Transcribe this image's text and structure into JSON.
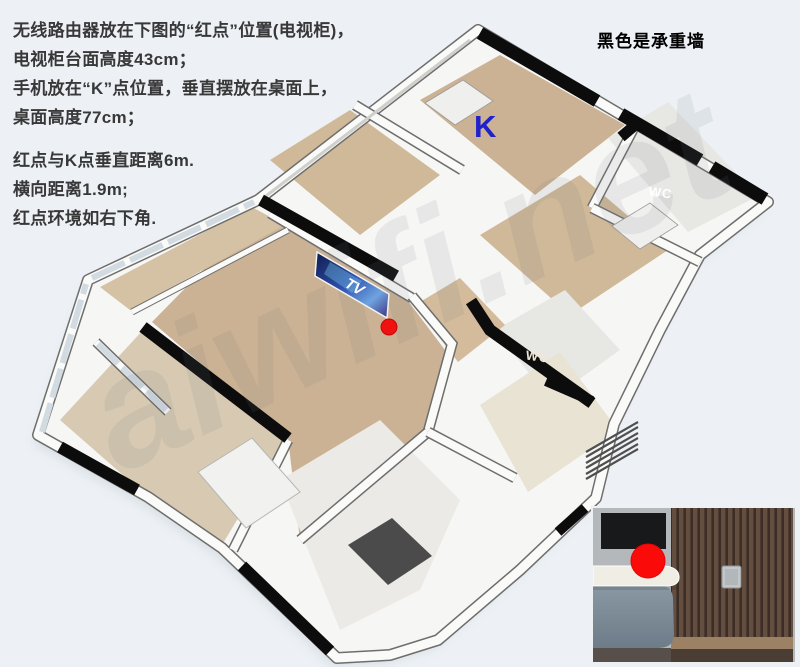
{
  "annotations": {
    "paragraph1": [
      "无线路由器放在下图的“红点”位置(电视柜)，",
      "电视柜台面高度43cm；",
      "手机放在“K”点位置，垂直摆放在桌面上，",
      "桌面高度77cm；"
    ],
    "paragraph2": [
      "红点与K点垂直距离6m.",
      "横向距离1.9m;",
      "红点环境如右下角."
    ],
    "legend": "黑色是承重墙"
  },
  "floorplan": {
    "k_point_label": "K",
    "tv_label": "TV",
    "wc_upper_label": "WC",
    "wc_lower_label": "WC"
  },
  "watermark": "aiwifi.net",
  "colors": {
    "background": "#edf1f5",
    "load_bearing_wall": "#0c0c0c",
    "wood_floor": "#cbb294",
    "red_marker": "#f01111",
    "k_label_blue": "#2121cc",
    "tv_screen_blue": "#2e4fae"
  }
}
